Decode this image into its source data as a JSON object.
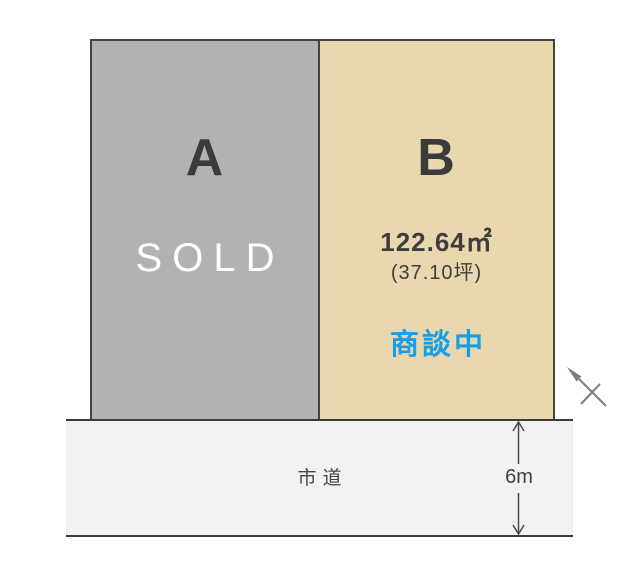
{
  "plot_a": {
    "label": "A",
    "status": "SOLD"
  },
  "plot_b": {
    "label": "B",
    "area_m2": "122.64㎡",
    "area_tsubo": "(37.10坪)",
    "status": "商談中"
  },
  "road": {
    "label": "市道",
    "width_label": "6m"
  },
  "icons": {
    "north_arrow": "north-arrow (diagonal arrow with cross tick, pointing upper-left)",
    "dimension_arrow": "vertical double-headed dimension arrow"
  },
  "colors": {
    "background": "#ffffff",
    "plot_a_fill": "#b2b2b4",
    "plot_b_fill": "#e9d8ae",
    "road_fill": "#f2f2f2",
    "border_dark": "#3a3a3a",
    "letter_dark": "#3b3b3b",
    "sold_white": "#ffffff",
    "status_blue": "#189ee4",
    "arrow_gray": "#7d7d7d"
  }
}
